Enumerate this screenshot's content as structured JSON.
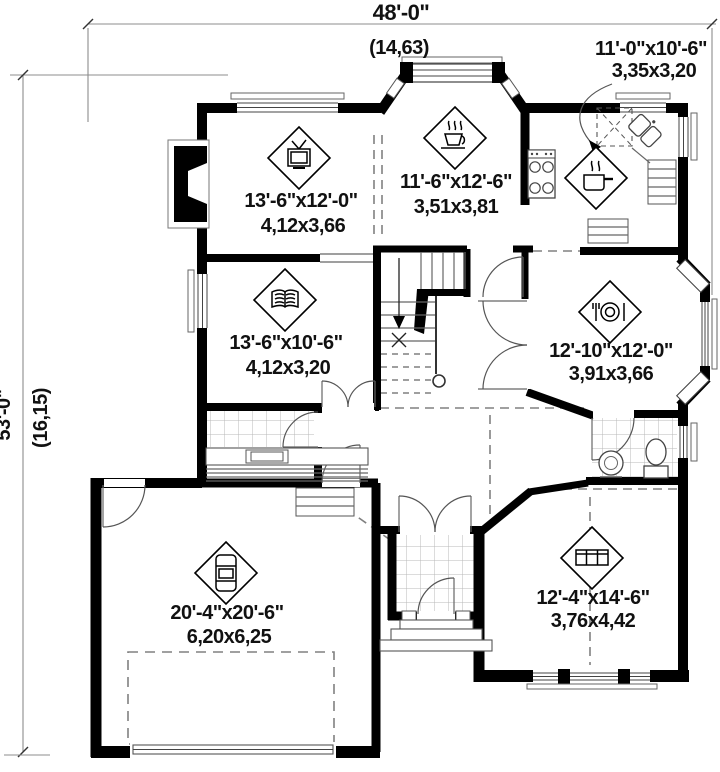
{
  "plan": {
    "overall": {
      "width_ft": "48'-0\"",
      "width_m": "(14,63)",
      "depth_ft": "53'-0\"",
      "depth_m": "(16,15)"
    },
    "rooms": [
      {
        "name": "kitchen",
        "icon": "cooking-pot-icon",
        "size_ft": "11'-0\"x10'-6\"",
        "size_m": "3,35x3,20"
      },
      {
        "name": "living-room",
        "icon": "tv-icon",
        "size_ft": "13'-6\"x12'-0\"",
        "size_m": "4,12x3,66"
      },
      {
        "name": "dinette",
        "icon": "coffee-cup-icon",
        "size_ft": "11'-6\"x12'-6\"",
        "size_m": "3,51x3,81"
      },
      {
        "name": "study",
        "icon": "open-book-icon",
        "size_ft": "13'-6\"x10'-6\"",
        "size_m": "4,12x3,20"
      },
      {
        "name": "dining-room",
        "icon": "place-setting-icon",
        "size_ft": "12'-10\"x12'-0\"",
        "size_m": "3,91x3,66"
      },
      {
        "name": "garage",
        "icon": "car-icon",
        "size_ft": "20'-4\"x20'-6\"",
        "size_m": "6,20x6,25"
      },
      {
        "name": "family-room",
        "icon": "sofa-icon",
        "size_ft": "12'-4\"x14'-6\"",
        "size_m": "3,76x4,42"
      }
    ],
    "colors": {
      "wall": "#000000",
      "thin_line": "#666666",
      "dimension_line": "#8c8c8c",
      "text": "#111111",
      "background": "#ffffff"
    }
  }
}
